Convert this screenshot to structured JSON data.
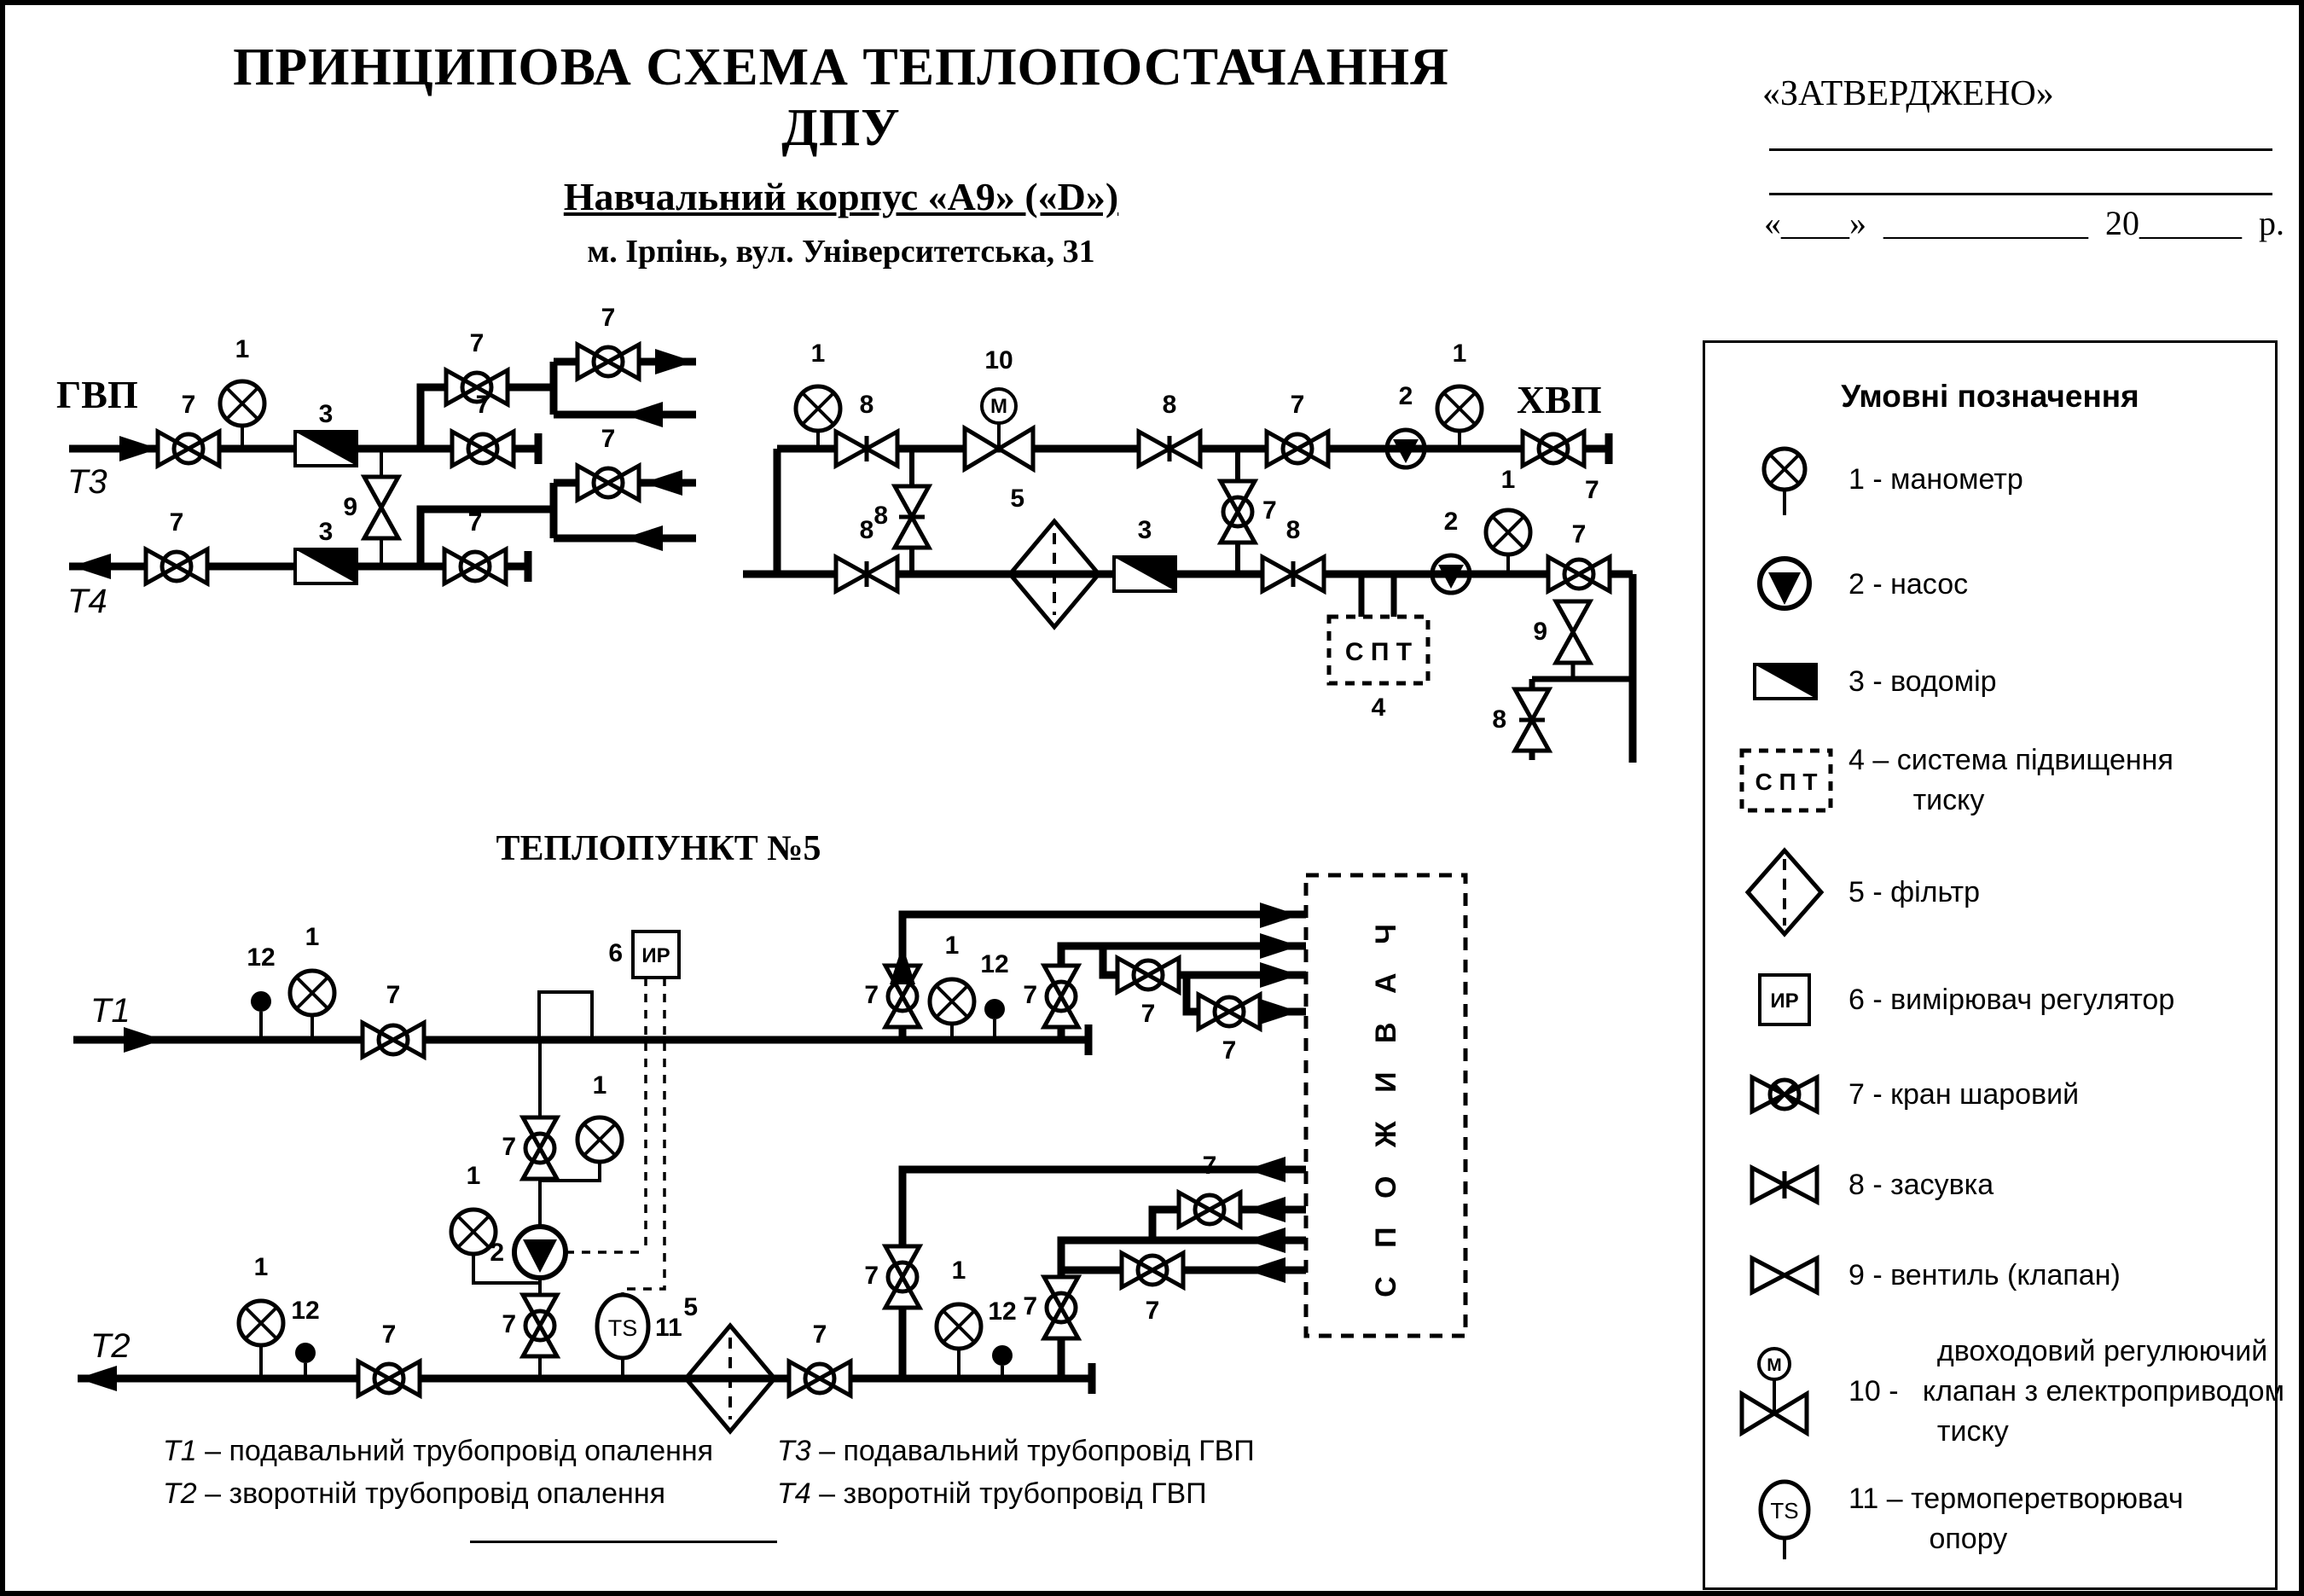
{
  "header": {
    "title": "ПРИНЦИПОВА СХЕМА ТЕПЛОПОСТАЧАННЯ ДПУ",
    "subtitle": "Навчальний корпус «А9» («D»)",
    "address": "м. Ірпінь, вул. Університетська, 31"
  },
  "approved": {
    "label": "«ЗАТВЕРДЖЕНО»",
    "date_line": "«____»  ____________  20______  р."
  },
  "legend": {
    "title": "Умовні позначення",
    "items": [
      {
        "icon": "manometer",
        "text": "1 - манометр"
      },
      {
        "icon": "pump",
        "text": "2 - насос"
      },
      {
        "icon": "water-meter",
        "text": "3 - водомір"
      },
      {
        "icon": "pressure-boost-system",
        "text": "4 – система підвищення\n        тиску"
      },
      {
        "icon": "filter",
        "text": "5 - фільтр"
      },
      {
        "icon": "measuring-regulator",
        "text": "6 - вимірювач регулятор"
      },
      {
        "icon": "ball-valve",
        "text": "7 - кран шаровий"
      },
      {
        "icon": "gate-valve",
        "text": "8 - засувка"
      },
      {
        "icon": "valve",
        "text": "9 - вентиль (клапан)"
      },
      {
        "icon": "two-way-control-valve",
        "text": "           двоходовий регулюючий\n10 -   клапан з електроприводом\n           тиску"
      },
      {
        "icon": "thermo-transducer",
        "text": "11 – термоперетворювач\n          опору"
      },
      {
        "icon": "temperature-sensor",
        "text": "12 - датчик температури"
      }
    ]
  },
  "sym": {
    "n1": "1",
    "n2": "2",
    "n3": "3",
    "n4": "4",
    "n5": "5",
    "n6": "6",
    "n7": "7",
    "n8": "8",
    "n9": "9",
    "n10": "10",
    "n11": "11",
    "n12": "12",
    "m": "M",
    "ts": "TS",
    "ir": "ИР",
    "spt": "С П Т",
    "gvp": "ГВП",
    "hvp": "ХВП",
    "t1": "Т1",
    "t2": "Т2",
    "t3": "Т3",
    "t4": "Т4",
    "heatpoint": "ТЕПЛОПУНКТ №5",
    "consumer": "С П О Ж И В А Ч"
  },
  "footnotes": {
    "f1": {
      "prefix": "Т1",
      "text": " – подавальний трубопровід опалення"
    },
    "f2": {
      "prefix": "Т2",
      "text": " – зворотній трубопровід опалення"
    },
    "f3": {
      "prefix": "Т3",
      "text": " – подавальний трубопровід ГВП"
    },
    "f4": {
      "prefix": "Т4",
      "text": " – зворотній трубопровід ГВП"
    }
  }
}
